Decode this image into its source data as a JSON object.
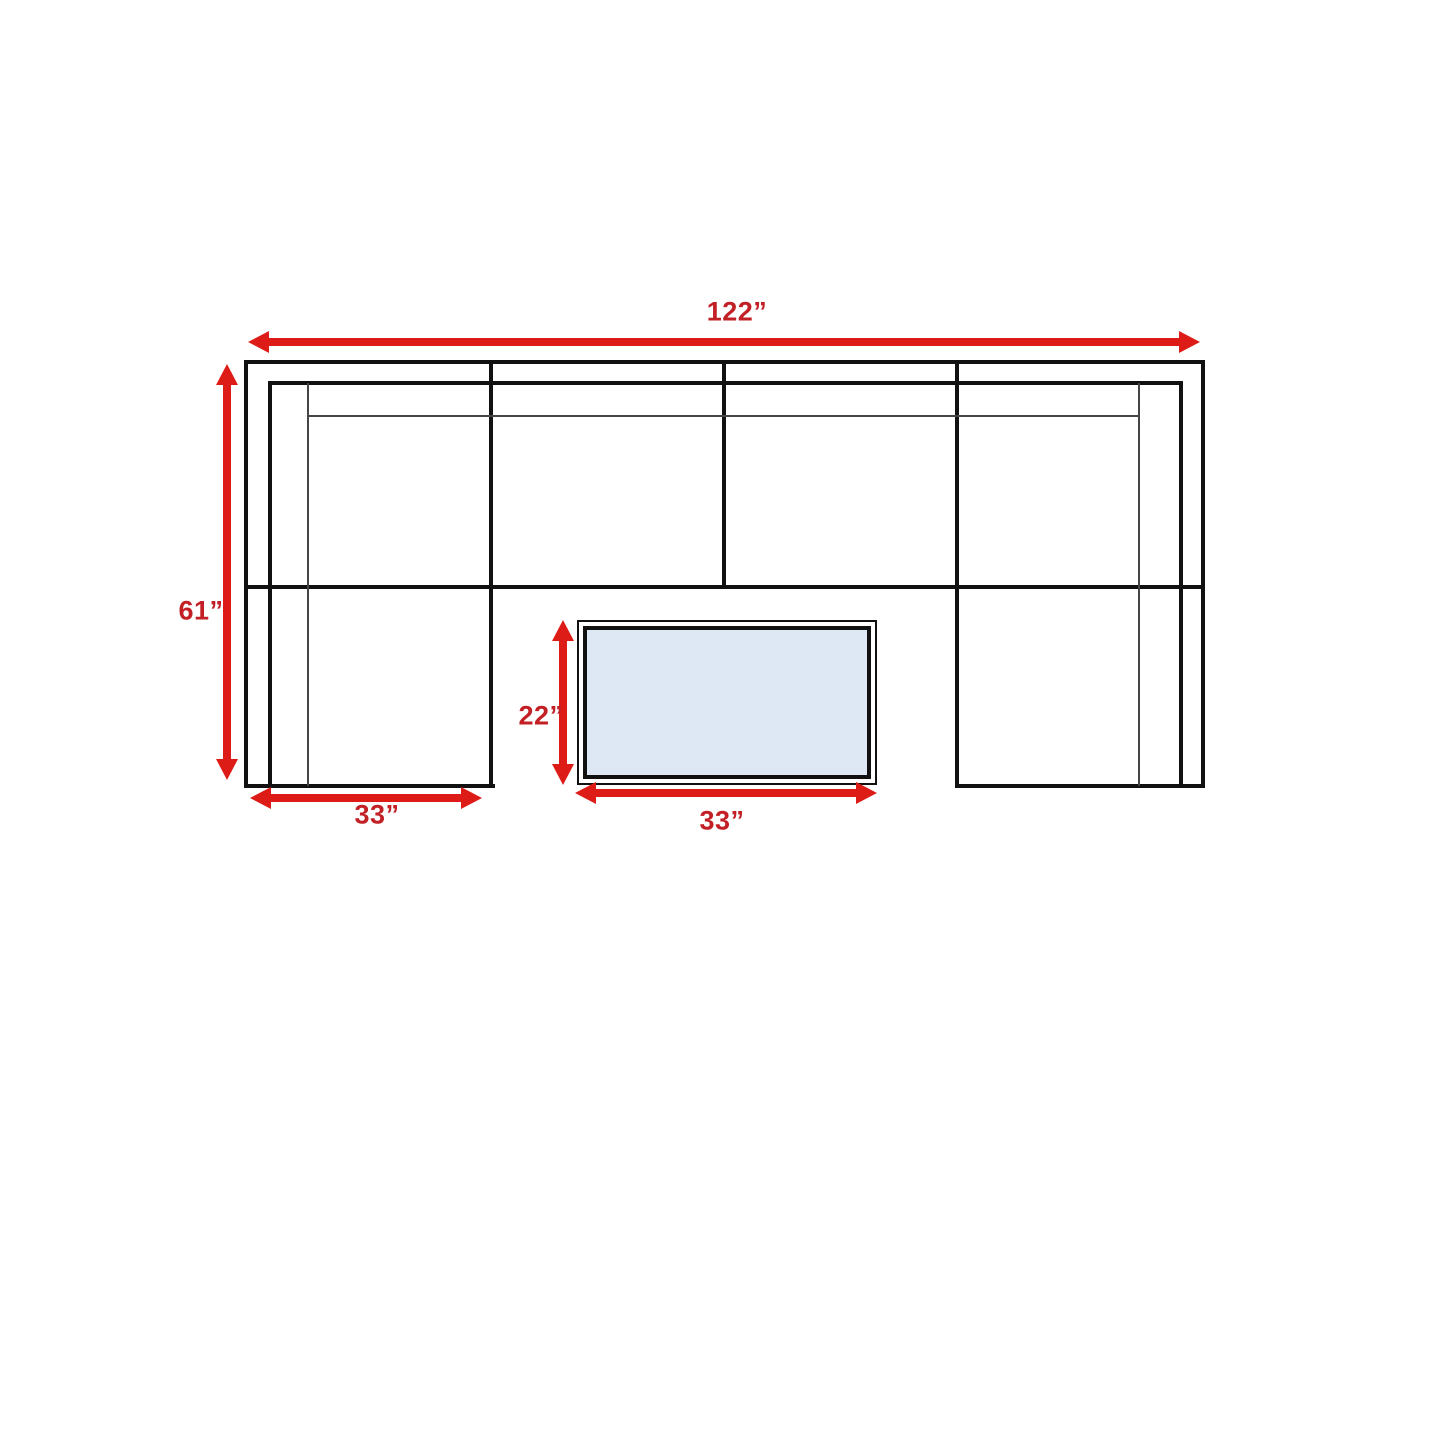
{
  "colors": {
    "line": "#111111",
    "thin_line": "#454545",
    "arrow": "#dd1c17",
    "label": "#c32026",
    "table_fill": "#dde8f4",
    "background": "#ffffff"
  },
  "diagram": {
    "type": "furniture-dimension-diagram",
    "dimensions": {
      "overall_width": {
        "label": "122”",
        "inches": 122
      },
      "overall_depth": {
        "label": "61”",
        "inches": 61
      },
      "left_chaise_width": {
        "label": "33”",
        "inches": 33
      },
      "table_width": {
        "label": "33”",
        "inches": 33
      },
      "table_depth": {
        "label": "22”",
        "inches": 22
      }
    }
  }
}
